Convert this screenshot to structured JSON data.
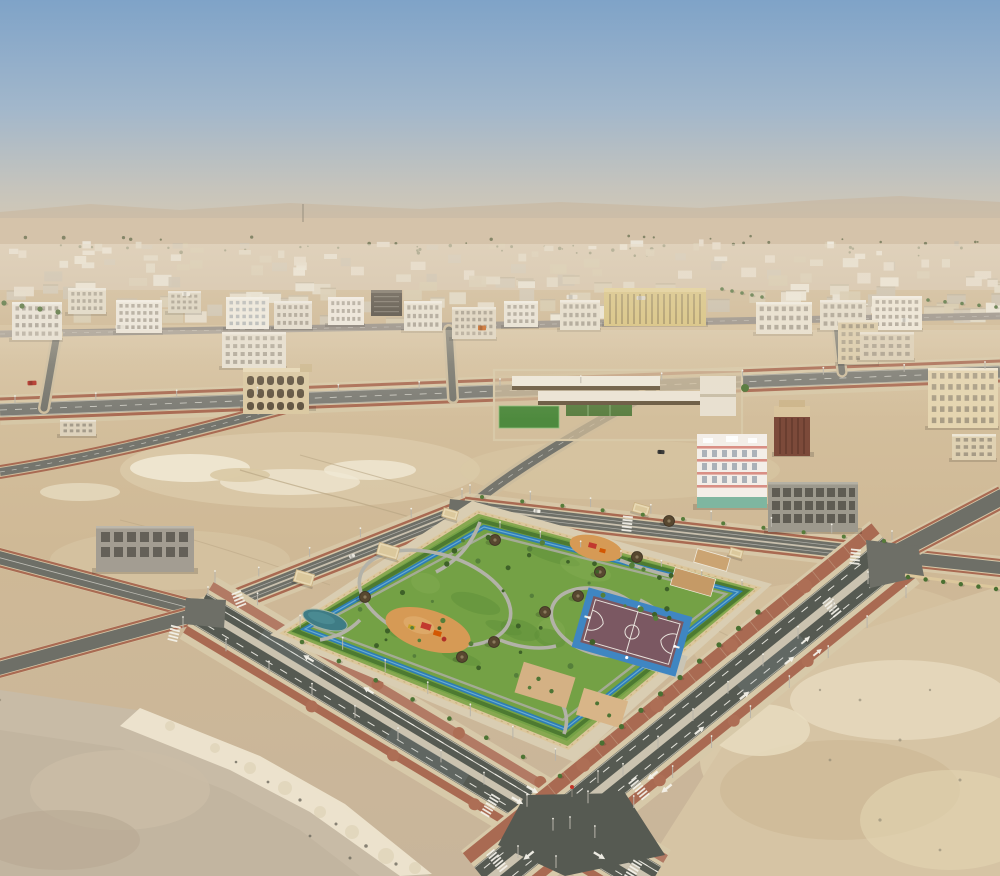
{
  "meta": {
    "title": "Aerial drone photograph of a desert city district with a landscaped neighborhood park, basketball court, boulevards and empty sand lots",
    "width": 1000,
    "height": 876
  },
  "palette": {
    "sky_top": "#7fa3c8",
    "sky_mid": "#a2b7cb",
    "sky_low": "#c6c4bc",
    "sky_horizon": "#d8cab2",
    "horizon_band": "#c7b197",
    "distant_sand": "#d5c3aa",
    "sand": "#cfb996",
    "sand_light": "#e6dabf",
    "sand_dark": "#b9a78c",
    "rubble_white": "#f0e8d4",
    "asphalt_dark": "#565a52",
    "asphalt_mid": "#6e6f67",
    "asphalt_light": "#82827a",
    "road_median": "#cbc3b0",
    "sidewalk_red": "#a96a52",
    "sidewalk_tan": "#d7c9a9",
    "curb_white": "#ece6d6",
    "park_grass": "#74a145",
    "grass_dark": "#5d8c36",
    "hedge_green": "#4d7a31",
    "track_blue": "#2e7eb4",
    "track_blue_light": "#6fb0d6",
    "pond_teal": "#3f7c85",
    "path_gray": "#b0afa5",
    "playground_sand": "#d69a55",
    "court_surface": "#7b5862",
    "court_border": "#3f86c2",
    "court_sand": "#c59a66",
    "gazebo_roof": "#57472f",
    "wall_tan": "#dcc79c",
    "building_white": "#efeae0",
    "building_beige": "#e3d8c2",
    "building_tan": "#dbc9a4",
    "building_yellow": "#d9c480",
    "building_dark": "#4a443c",
    "building_maroon": "#7c4a3a",
    "concrete_frame": "#9d988c",
    "pink_trim": "#d98f85",
    "shopfront_green": "#7fb6a0",
    "tree_green": "#4d7434",
    "tree_dark": "#3e6128",
    "window_dark": "#6e6659",
    "window_blue": "#7d8a96",
    "marking_white": "#f4f2ea"
  },
  "scene": {
    "distant_city": {
      "seed": 7,
      "count": 170,
      "y_min": 246,
      "y_max": 330,
      "colors": [
        "#ece7db",
        "#e3dbc9",
        "#d9cdb4",
        "#cfc6b4",
        "#e8dfd0",
        "#d6c9ac",
        "#c9bfae",
        "#f0ebe0"
      ]
    },
    "far_trees": {
      "seed": 11,
      "count": 60,
      "y_min": 236,
      "y_max": 256,
      "color": "#6a7252"
    },
    "tree_rows": [
      [
        758,
        612,
        602,
        743,
        9,
        2.6,
        "#4a7032"
      ],
      [
        302,
        642,
        560,
        776,
        8,
        2.3,
        "#4d7434"
      ],
      [
        482,
        497,
        884,
        541,
        11,
        2.0,
        "#567c3a"
      ],
      [
        4,
        303,
        58,
        312,
        4,
        2.6,
        "#4e6e38"
      ],
      [
        722,
        289,
        762,
        297,
        5,
        1.8,
        "#486a34"
      ],
      [
        928,
        300,
        996,
        307,
        5,
        1.8,
        "#486a34"
      ],
      [
        908,
        577,
        996,
        589,
        6,
        2.2,
        "#4a7032"
      ]
    ],
    "buildings": [
      {
        "x": 12,
        "y": 302,
        "w": 50,
        "h": 38,
        "c": "#eae5da",
        "f": 4,
        "cols": 7
      },
      {
        "x": 68,
        "y": 288,
        "w": 38,
        "h": 26,
        "c": "#e3dcca",
        "f": 3,
        "cols": 6
      },
      {
        "x": 116,
        "y": 300,
        "w": 46,
        "h": 33,
        "c": "#eee9df",
        "f": 4,
        "cols": 7
      },
      {
        "x": 168,
        "y": 291,
        "w": 33,
        "h": 22,
        "c": "#dcd5c3",
        "f": 3,
        "cols": 5
      },
      {
        "x": 226,
        "y": 297,
        "w": 43,
        "h": 32,
        "c": "#f1ede3",
        "f": 4,
        "cols": 6,
        "wc": "#7d8a96"
      },
      {
        "x": 274,
        "y": 301,
        "w": 38,
        "h": 28,
        "c": "#e6dfd1",
        "f": 3,
        "cols": 6
      },
      {
        "x": 328,
        "y": 297,
        "w": 36,
        "h": 28,
        "c": "#f0eae0",
        "f": 3,
        "cols": 6
      },
      {
        "x": 404,
        "y": 301,
        "w": 38,
        "h": 30,
        "c": "#e9e3d5",
        "f": 3,
        "cols": 6
      },
      {
        "x": 452,
        "y": 307,
        "w": 44,
        "h": 32,
        "c": "#e0d7c4",
        "f": 4,
        "cols": 7
      },
      {
        "x": 504,
        "y": 301,
        "w": 34,
        "h": 26,
        "c": "#eae5d9",
        "f": 3,
        "cols": 5
      },
      {
        "x": 560,
        "y": 300,
        "w": 40,
        "h": 30,
        "c": "#e7e0d0",
        "f": 3,
        "cols": 6
      },
      {
        "x": 756,
        "y": 302,
        "w": 56,
        "h": 32,
        "c": "#eae3d3",
        "f": 3,
        "cols": 7
      },
      {
        "x": 820,
        "y": 300,
        "w": 46,
        "h": 30,
        "c": "#e6decd",
        "f": 3,
        "cols": 6
      },
      {
        "x": 872,
        "y": 296,
        "w": 50,
        "h": 34,
        "c": "#f0e9db",
        "f": 4,
        "cols": 7
      },
      {
        "x": 838,
        "y": 320,
        "w": 40,
        "h": 44,
        "c": "#dbcba8",
        "f": 5,
        "cols": 5
      },
      {
        "x": 928,
        "y": 368,
        "w": 70,
        "h": 60,
        "c": "#e5d5b0",
        "f": 5,
        "cols": 8
      },
      {
        "x": 952,
        "y": 434,
        "w": 44,
        "h": 26,
        "c": "#dfd1b2",
        "f": 3,
        "cols": 5
      },
      {
        "x": 860,
        "y": 332,
        "w": 54,
        "h": 28,
        "c": "#dccfb6",
        "f": 3,
        "cols": 6
      },
      {
        "x": 222,
        "y": 332,
        "w": 64,
        "h": 36,
        "c": "#e8e2d4",
        "f": 4,
        "cols": 8
      },
      {
        "x": 60,
        "y": 420,
        "w": 36,
        "h": 16,
        "c": "#ddd2bc",
        "f": 2,
        "cols": 5
      }
    ],
    "vehicles": [
      [
        32,
        383,
        9,
        4.5,
        "#b23127",
        -2
      ],
      [
        186,
        294,
        8,
        4,
        "#f2efe6",
        0
      ],
      [
        572,
        297,
        11,
        4.5,
        "#e9e5da",
        0
      ],
      [
        641,
        298,
        9,
        4,
        "#dcd7cb",
        0
      ],
      [
        482,
        328,
        8,
        5,
        "#cc6d2b",
        0
      ],
      [
        661,
        452,
        7,
        4,
        "#3c3c3a",
        4
      ],
      [
        905,
        320,
        8,
        4,
        "#efece2",
        0
      ],
      [
        537,
        511,
        7,
        3.5,
        "#f1eee5",
        6
      ],
      [
        352,
        556,
        6,
        3.5,
        "#e8e5dc",
        -21
      ],
      [
        120,
        327,
        9,
        4,
        "#e6e1d5",
        0
      ]
    ],
    "pole_rows": [
      [
        215,
        583,
        598,
        783,
        46,
        12
      ],
      [
        183,
        629,
        570,
        829,
        46,
        12
      ],
      [
        868,
        584,
        518,
        858,
        46,
        12
      ],
      [
        906,
        598,
        556,
        868,
        50,
        12
      ],
      [
        470,
        494,
        892,
        540,
        62,
        9
      ],
      [
        208,
        596,
        462,
        498,
        56,
        9
      ],
      [
        15,
        403,
        985,
        369,
        78,
        7
      ],
      [
        500,
        528,
        742,
        586,
        44,
        6
      ]
    ],
    "park": {
      "wall": [
        [
          478,
          512
        ],
        [
          758,
          588
        ],
        [
          568,
          748
        ],
        [
          283,
          633
        ]
      ],
      "gazebos": [
        [
          495,
          540
        ],
        [
          600,
          572
        ],
        [
          578,
          596
        ],
        [
          545,
          612
        ],
        [
          494,
          642
        ],
        [
          462,
          657
        ],
        [
          365,
          597
        ],
        [
          637,
          557
        ],
        [
          669,
          521
        ]
      ],
      "corner_buildings": [
        [
          304,
          578,
          19,
          12
        ],
        [
          388,
          551,
          21,
          12
        ],
        [
          450,
          514,
          15,
          9
        ],
        [
          641,
          509,
          16,
          9
        ],
        [
          736,
          553,
          13,
          8
        ]
      ],
      "interior_trees": {
        "seed": 5,
        "count": 46,
        "color": "#3e6128"
      },
      "grass_mottle": {
        "seed": 9,
        "count": 12
      }
    }
  }
}
